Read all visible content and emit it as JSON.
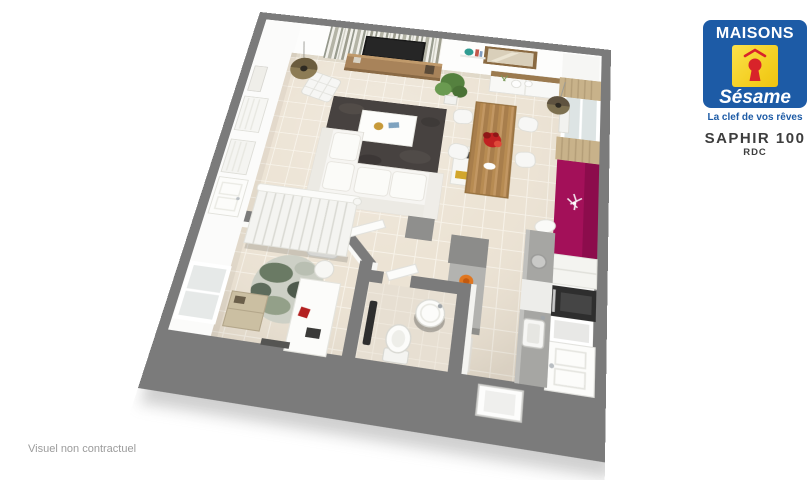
{
  "brand": {
    "name": "MAISONS",
    "sub": "Sésame",
    "tagline": "La clef de vos rêves",
    "blue": "#1d5ba6",
    "yellow": "#f3cd1d",
    "red": "#d8232a"
  },
  "title": {
    "model": "SAPHIR 100",
    "level": "RDC"
  },
  "footer": {
    "disclaimer": "Visuel non contractuel"
  },
  "palette": {
    "wall_gray": "#7b7b7b",
    "floor_tile": "#ece3d4",
    "grout": "#f7f2e8",
    "accent_magenta": "#a31059",
    "wood": "#b78b52",
    "rug_dark": "#474240",
    "counter_gray": "#a6a6a3"
  },
  "scene": {
    "view": "3d-perspective-floor-plan",
    "rooms": [
      "salon-sejour",
      "coin-repas",
      "cuisine-ouverte",
      "chambre-bureau",
      "salle-d-eau-wc",
      "escalier",
      "entree"
    ],
    "objects": [
      "birch-wallpaper",
      "tv",
      "tv-console",
      "pendant-lamp",
      "barcelona-chair",
      "dark-rug",
      "coffee-table",
      "corner-sofa",
      "bookshelf",
      "plant",
      "shelf-vase",
      "mirror",
      "sideboard",
      "window-curtains",
      "radiator",
      "magenta-accent-wall",
      "wall-clock",
      "dining-table",
      "red-flowers",
      "dining-chair",
      "kitchen-island",
      "bar-stool",
      "kitchen-counter",
      "sink",
      "oven",
      "kitchen-window",
      "front-door",
      "doormat",
      "gray-mat",
      "staircase",
      "stair-railing",
      "bedroom-shelves",
      "bedroom-window",
      "round-camo-rug",
      "desk",
      "desk-chair",
      "wood-cabinet",
      "bathroom",
      "washbasin",
      "toilet",
      "towel-radiator",
      "bathroom-door",
      "bedroom-door"
    ]
  }
}
